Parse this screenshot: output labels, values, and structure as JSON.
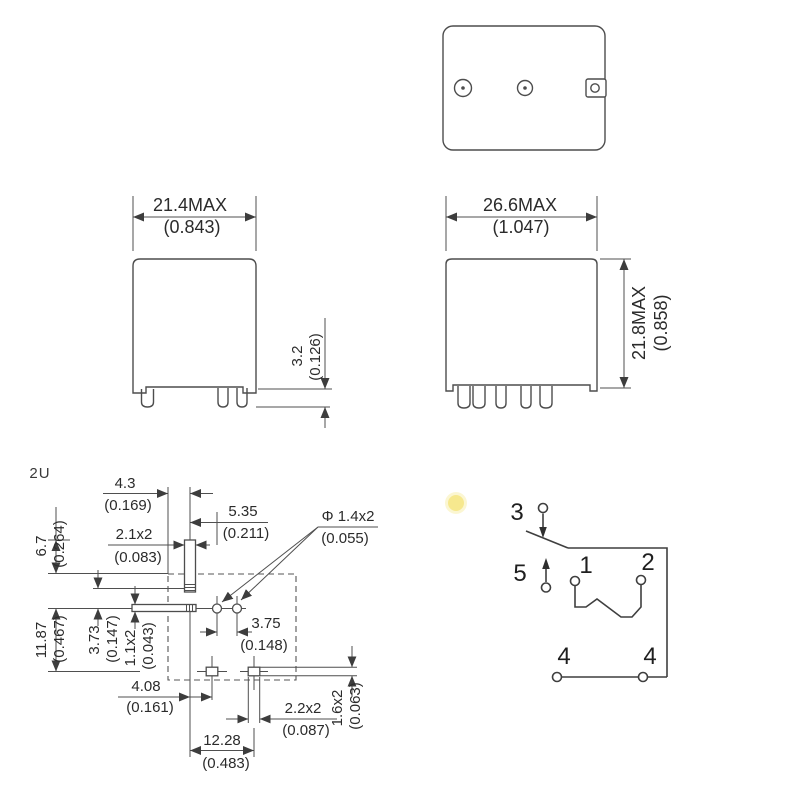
{
  "page": {
    "note_fragment": "2U"
  },
  "colors": {
    "line": "#4d4d4d",
    "text": "#2b2b2b",
    "highlight_dot": "#f6e88e"
  },
  "views": {
    "front_view": {
      "width_mm": "21.4MAX",
      "width_in": "(0.843)",
      "pin_mm": "3.2",
      "pin_in": "(0.126)"
    },
    "side_view": {
      "width_mm": "26.6MAX",
      "width_in": "(1.047)",
      "height_mm": "21.8MAX",
      "height_in": "(0.858)"
    },
    "pcb_layout": {
      "d43_mm": "4.3",
      "d43_in": "(0.169)",
      "d535_mm": "5.35",
      "d535_in": "(0.211)",
      "d21x2_mm": "2.1x2",
      "d21x2_in": "(0.083)",
      "dphi_mm": "Φ 1.4x2",
      "dphi_in": "(0.055)",
      "d67_mm": "6.7",
      "d67_in": "(0.264)",
      "d1187_mm": "11.87",
      "d1187_in": "(0.467)",
      "d373_mm": "3.73",
      "d373_in": "(0.147)",
      "d11x2_mm": "1.1x2",
      "d11x2_in": "(0.043)",
      "d375_mm": "3.75",
      "d375_in": "(0.148)",
      "d408_mm": "4.08",
      "d408_in": "(0.161)",
      "d22x2_mm": "2.2x2",
      "d22x2_in": "(0.087)",
      "d16x2_mm": "1.6x2",
      "d16x2_in": "(0.063)",
      "d1228_mm": "12.28",
      "d1228_in": "(0.483)"
    },
    "schematic": {
      "pin3": "3",
      "pin5": "5",
      "pin1": "1",
      "pin2": "2",
      "pin4_left": "4",
      "pin4_right": "4"
    }
  }
}
